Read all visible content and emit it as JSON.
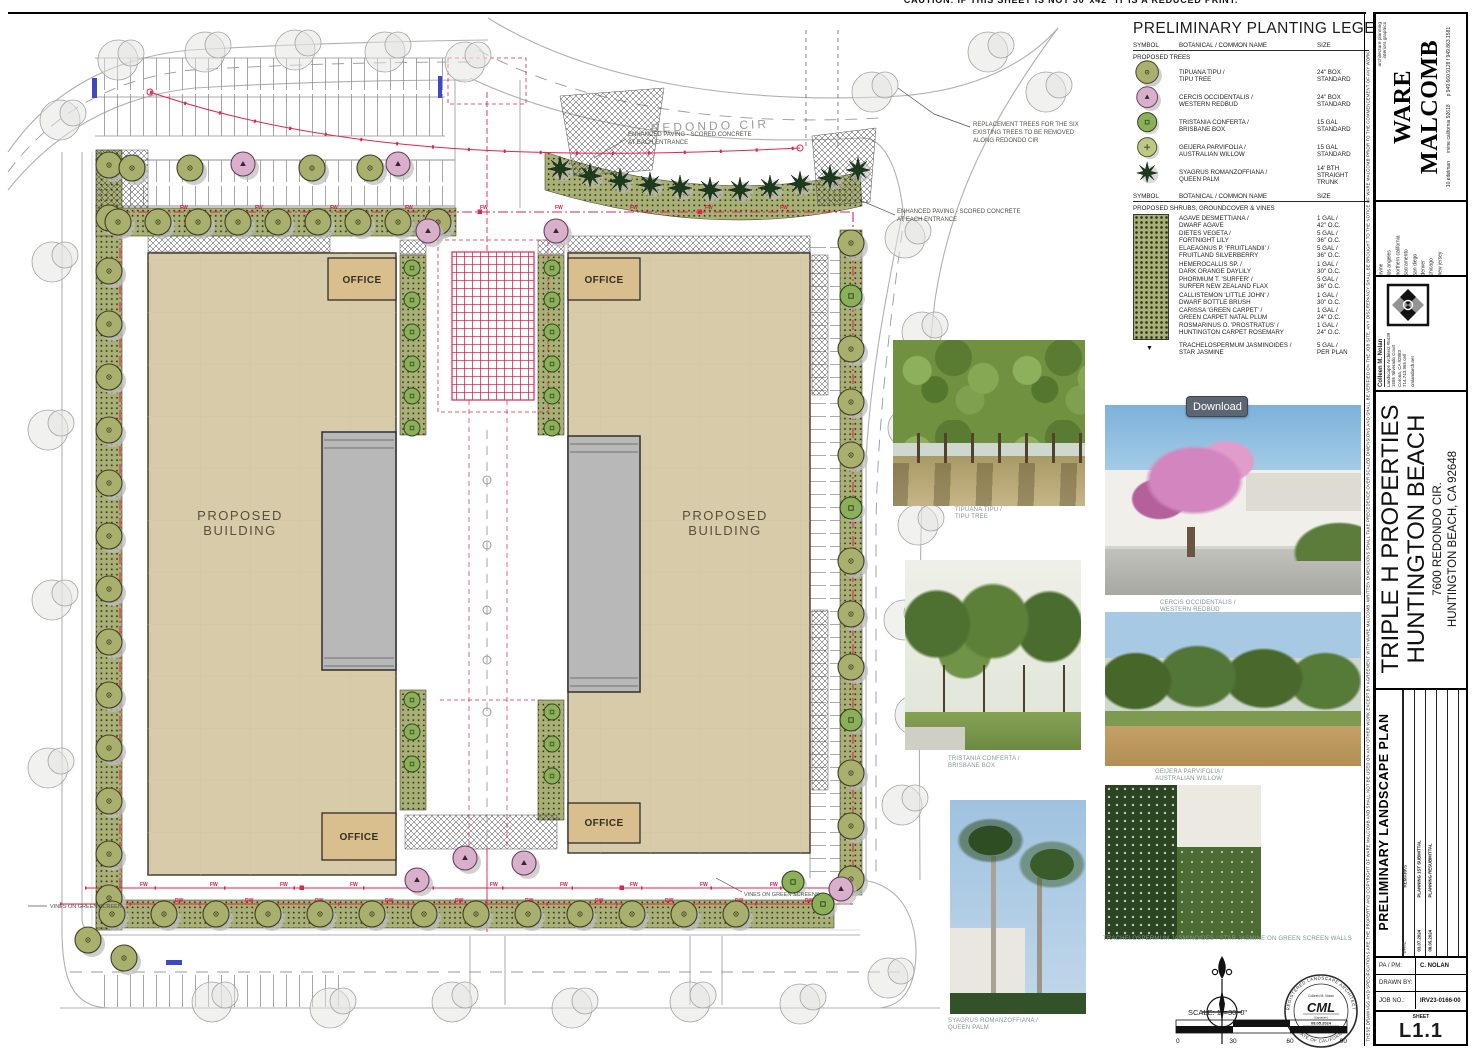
{
  "caution": "CAUTION:   IF THIS SHEET IS NOT 30\"x42\"  IT IS A REDUCED PRINT.",
  "download_label": "Download",
  "legend": {
    "title": "PRELIMINARY PLANTING LEGEND",
    "headers": {
      "symbol": "SYMBOL",
      "name": "BOTANICAL / COMMON NAME",
      "size": "SIZE"
    },
    "trees_heading": "PROPOSED TREES",
    "shrubs_heading": "PROPOSED SHRUBS, GROUNDCOVER & VINES",
    "star_symbol": "▼",
    "trees": [
      {
        "botanical": "TIPUANA TIPU /",
        "common": "TIPU TREE",
        "size1": "24\" BOX",
        "size2": "STANDARD"
      },
      {
        "botanical": "CERCIS OCCIDENTALIS /",
        "common": "WESTERN REDBUD",
        "size1": "24\" BOX",
        "size2": "STANDARD"
      },
      {
        "botanical": "TRISTANIA CONFERTA /",
        "common": "BRISBANE BOX",
        "size1": "15 GAL",
        "size2": "STANDARD"
      },
      {
        "botanical": "GEIJERA PARVIFOLIA /",
        "common": "AUSTRALIAN WILLOW",
        "size1": "15 GAL",
        "size2": "STANDARD"
      },
      {
        "botanical": "SYAGRUS ROMANZOFFIANA /",
        "common": "QUEEN PALM",
        "size1": "14' BTH",
        "size2": "STRAIGHT TRUNK"
      }
    ],
    "shrubs": [
      {
        "botanical": "AGAVE DESMETTIANA /",
        "common": "DWARF AGAVE",
        "size1": "1 GAL /",
        "size2": "42\" O.C."
      },
      {
        "botanical": "DIETES VEGETA /",
        "common": "FORTNIGHT LILY",
        "size1": "5 GAL /",
        "size2": "36\" O.C."
      },
      {
        "botanical": "ELAEAGNUS P. 'FRUITLANDII' /",
        "common": "FRUITLAND SILVERBERRY",
        "size1": "5 GAL /",
        "size2": "36\" O.C."
      },
      {
        "botanical": "HEMEROCALLIS SP. /",
        "common": "DARK ORANGE DAYLILY",
        "size1": "1 GAL /",
        "size2": "30\" O.C."
      },
      {
        "botanical": "PHORMIUM T. 'SURFER' /",
        "common": "SURFER NEW ZEALAND FLAX",
        "size1": "5 GAL /",
        "size2": "36\" O.C."
      },
      {
        "botanical": "CALLISTEMON 'LITTLE JOHN' /",
        "common": "DWARF BOTTLE BRUSH",
        "size1": "1 GAL /",
        "size2": "30\" O.C."
      },
      {
        "botanical": "CARISSA 'GREEN CARPET' /",
        "common": "GREEN CARPET NATAL PLUM",
        "size1": "1 GAL /",
        "size2": "24\" O.C."
      },
      {
        "botanical": "ROSMARINUS O. 'PROSTRATUS' /",
        "common": "HUNTINGTON CARPET ROSEMARY",
        "size1": "1 GAL /",
        "size2": "24\" O.C."
      },
      {
        "botanical": "TRACHELOSPERMUM JASMINOIDES /",
        "common": "STAR JASMINE",
        "size1": "5 GAL /",
        "size2": "PER PLAN"
      }
    ]
  },
  "plan": {
    "street_label": "REDONDO CIR",
    "building_line1": "PROPOSED",
    "building_line2": "BUILDING",
    "office_label": "OFFICE",
    "pipe_fw": "FW",
    "pipe_dw": "DW",
    "notes": {
      "enhanced_paving_1": "ENHANCED PAVING - SCORED CONCRETE",
      "enhanced_paving_2": "AT EACH ENTRANCE",
      "replacement_1": "REPLACEMENT TREES FOR THE SIX",
      "replacement_2": "EXISTING TREES TO BE REMOVED",
      "replacement_3": "ALONG REDONDO CIR",
      "vines_left": "VINES ON GREEN SCREEN",
      "vines_right": "VINES ON GREEN SCREENS"
    }
  },
  "photos": [
    {
      "caption1": "TIPUANA TIPU /",
      "caption2": "TIPU TREE"
    },
    {
      "caption1": "CERCIS OCCIDENTALIS /",
      "caption2": "WESTERN REDBUD"
    },
    {
      "caption1": "TRISTANIA CONFERTA /",
      "caption2": "BRISBANE BOX"
    },
    {
      "caption1": "GEIJERA PARVIFOLIA /",
      "caption2": "AUSTRALIAN WILLOW"
    },
    {
      "caption1": "SYAGRUS ROMANZOFFIANA /",
      "caption2": "QUEEN PALM"
    },
    {
      "caption1": "TRACHELOSPERMUM JASMINOIDES / STAR JASMINE ON GREEN SCREEN WALLS",
      "caption2": ""
    }
  ],
  "scale": {
    "label": "SCALE:  1\"=30'-0\"",
    "t0": "0",
    "t30": "30",
    "t60": "60",
    "t90": "90"
  },
  "stamp": {
    "arc_top": "REGISTERED LANDSCAPE ARCHITECT",
    "arc_bottom": "STATE OF CALIFORNIA",
    "name": "Colleen M. Nolan",
    "signature": "CML",
    "sig_label": "(Signature)",
    "date": "08.05.2024",
    "date_label": "(Date)"
  },
  "titleblock": {
    "firm": {
      "name": "WARE MALCOMB",
      "services": [
        "architecture",
        "planning",
        "interiors",
        "graphics"
      ],
      "address1": "10 edelman",
      "address2": "irvine california 92618",
      "address3": "p 949.660.9128  f 949.863.1581",
      "offices": [
        "irvine",
        "los angeles",
        "northern california",
        "sacramento",
        "san diego",
        "denver",
        "chicago",
        "new jersey"
      ]
    },
    "consultant": {
      "name": "Colleen M. Nolan",
      "line1": "Landscape Architect #5439",
      "line2": "1585 Silverado Court",
      "line3": "Corona, CA 92883",
      "line4": "714.743.965 cell",
      "line5": "cmlandarch.net"
    },
    "project": {
      "client": "TRIPLE H PROPERTIES",
      "city": "HUNTINGTON BEACH",
      "address1": "7600 REDONDO CIR.",
      "address2": "HUNTINGTON BEACH, CA 92648"
    },
    "sheet_title": "PRELIMINARY LANDSCAPE PLAN",
    "revisions": {
      "date_header": "DATE",
      "remarks_header": "REMARKS",
      "rows": [
        {
          "date": "03.07.2024",
          "remark": "PLANNING 1ST SUBMITTAL"
        },
        {
          "date": "08.05.2024",
          "remark": "PLANNING RESUBMITTAL"
        }
      ]
    },
    "info": {
      "pa_label": "PA / PM:",
      "pa_value": "C. NOLAN",
      "drawn_label": "DRAWN BY:",
      "drawn_value": "",
      "job_label": "JOB NO.:",
      "job_value": "IRV23-0166-00"
    },
    "sheet_label": "SHEET",
    "sheet_number": "L1.1",
    "disclaimer": "THESE DRAWINGS AND SPECIFICATIONS ARE THE PROPERTY AND COPYRIGHT OF WARE MALCOMB AND SHALL NOT BE USED ON ANY OTHER WORK EXCEPT BY AGREEMENT WITH WARE MALCOMB. WRITTEN DIMENSIONS SHALL TAKE PRECEDENCE OVER SCALED DIMENSIONS AND SHALL BE VERIFIED ON THE JOB SITE. ANY DISCREPANCY SHALL BE BROUGHT TO THE NOTICE OF WARE MALCOMB PRIOR TO THE COMMENCEMENT OF ANY WORK."
  },
  "colors": {
    "accent_red": "#E0254F",
    "tree_olive": "#A9AF6D",
    "tree_pink": "#D9B0CC",
    "building_tan": "#D8CBAA",
    "office_tan": "#D9BF8D"
  },
  "icons": {
    "north_arrow": "north-arrow-compass",
    "consultant_logo": "ornamental-square-mark",
    "architect_seal": "round-seal"
  }
}
